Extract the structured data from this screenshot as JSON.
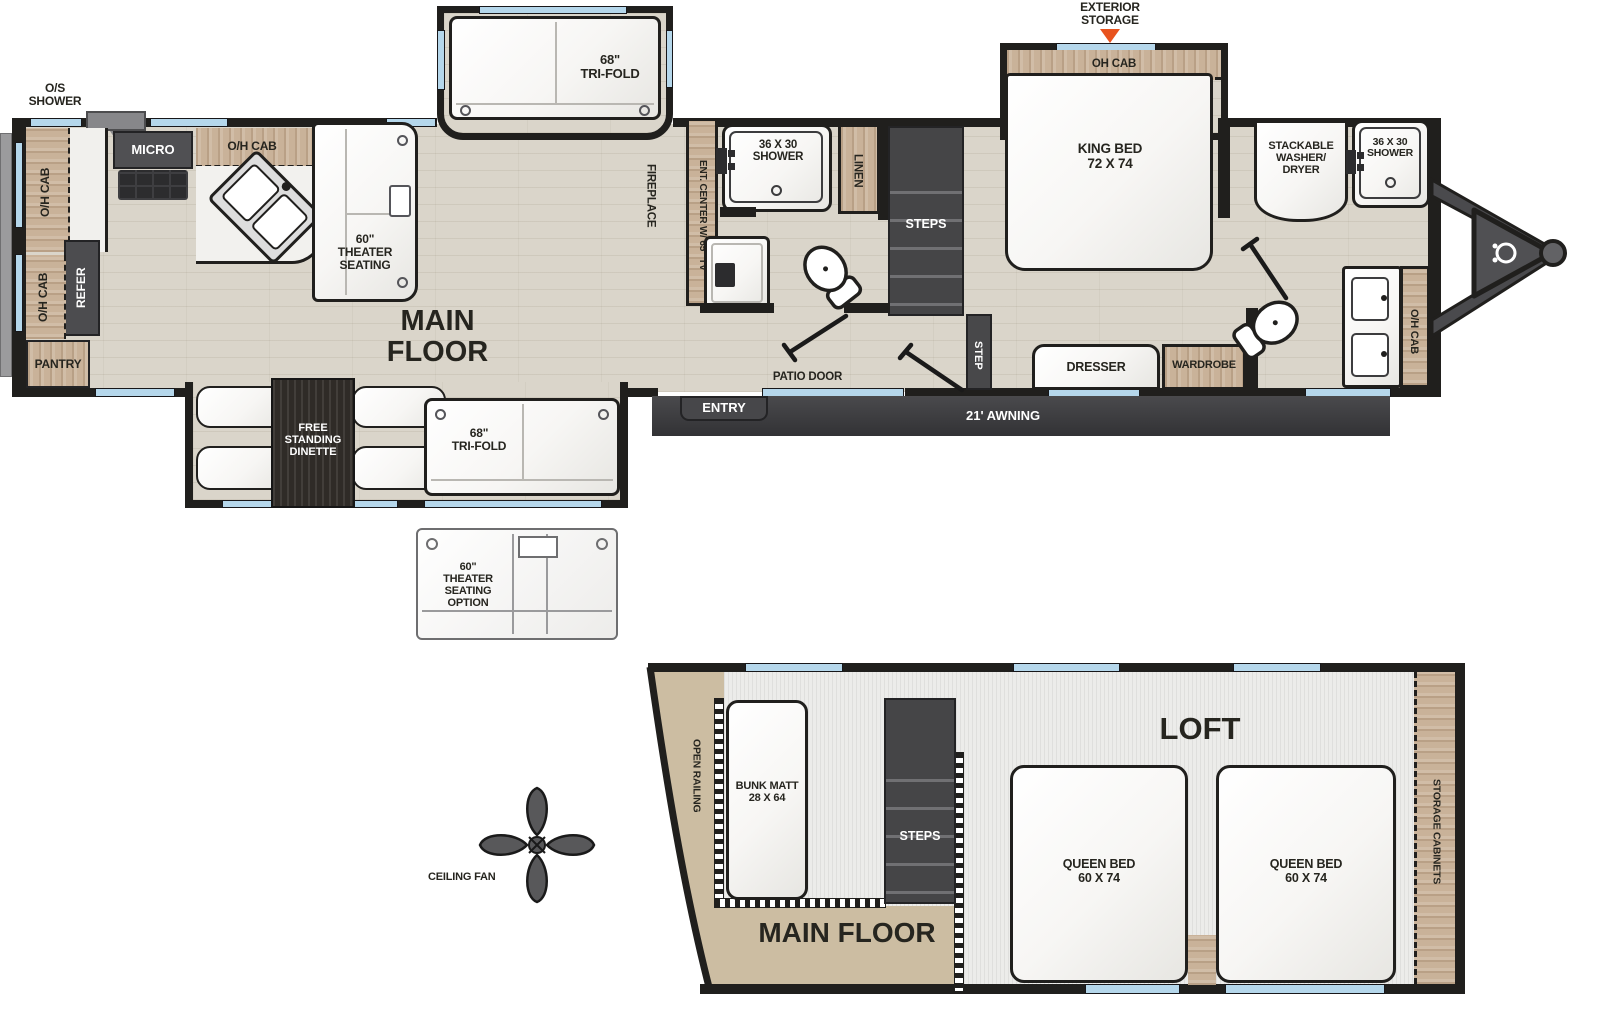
{
  "main": {
    "kitchen": {
      "os_shower": "O/S\nSHOWER",
      "oh_cab_upper": "O/H CAB",
      "oh_cab_top": "O/H CAB",
      "micro": "MICRO",
      "refer": "REFER",
      "oh_cab_lower": "O/H CAB",
      "pantry": "PANTRY",
      "theater_seating": "60\"\nTHEATER\nSEATING"
    },
    "living": {
      "tri_fold_slide": "68\"\nTRI-FOLD",
      "main_floor": "MAIN FLOOR",
      "fireplace": "FIREPLACE",
      "ent_center": "ENT. CENTER W/ 65\" TV"
    },
    "mid_bath": {
      "shower": "36 X 30\nSHOWER",
      "linen": "LINEN",
      "steps": "STEPS"
    },
    "bedroom": {
      "exterior_storage": "EXTERIOR\nSTORAGE",
      "oh_cab": "OH CAB",
      "king_bed": "KING BED\n72 X 74",
      "dresser": "DRESSER",
      "wardrobe": "WARDROBE",
      "step": "STEP"
    },
    "front_bath": {
      "washer": "STACKABLE\nWASHER/\nDRYER",
      "shower": "36 X 30\nSHOWER",
      "oh_cab": "O/H CAB"
    },
    "dinette_slide": {
      "dinette": "FREE\nSTANDING\nDINETTE",
      "tri_fold": "68\"\nTRI-FOLD"
    },
    "exterior": {
      "entry": "ENTRY",
      "patio_door": "PATIO DOOR",
      "awning": "21' AWNING"
    }
  },
  "options": {
    "theater_option": "60\"\nTHEATER\nSEATING\nOPTION",
    "ceiling_fan": "CEILING FAN"
  },
  "loft": {
    "title": "LOFT",
    "open_railing": "OPEN RAILING",
    "bunk": "BUNK MATT\n28 X 64",
    "steps": "STEPS",
    "queen_bed_left": "QUEEN BED\n60 X 74",
    "queen_bed_right": "QUEEN BED\n60 X 74",
    "storage_cabinets": "STORAGE  CABINETS",
    "main_floor": "MAIN FLOOR"
  },
  "colors": {
    "wall": "#201f1d",
    "cabinet_wood": "#c9b299",
    "floor_wood": "#dad5ca",
    "window_blue": "#b5d7eb",
    "dark_fixture": "#4b4b4e",
    "accent_orange": "#e8531e"
  }
}
